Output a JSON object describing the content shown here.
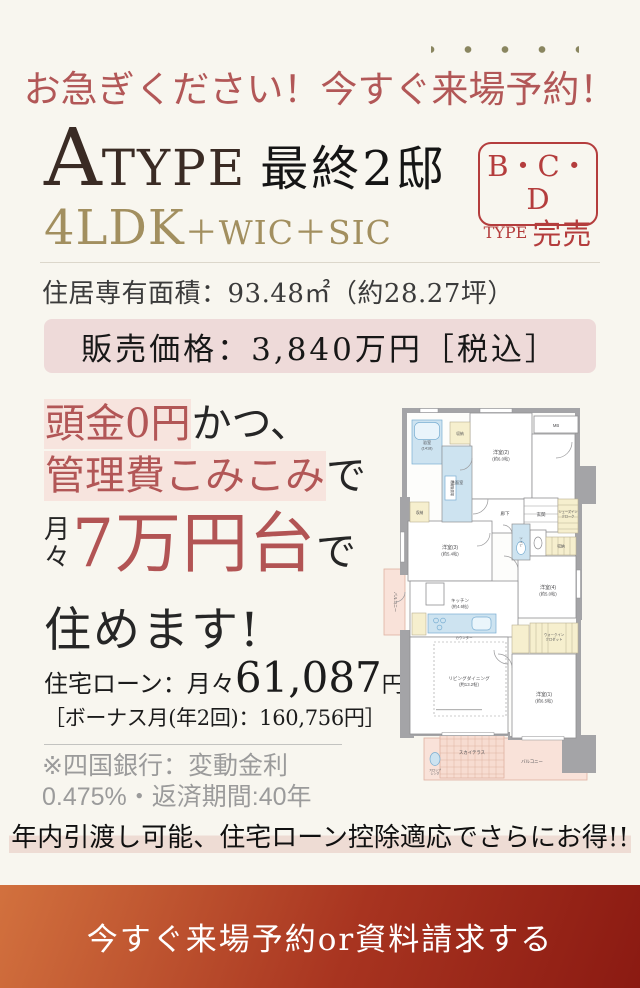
{
  "headline": {
    "pre": "お急ぎください！今すぐ",
    "emph": "来場予約",
    "post": "！",
    "color": "#b25757",
    "dot_color": "#8a8660"
  },
  "type_block": {
    "a": "A",
    "type": "TYPE",
    "rest": "最終2邸",
    "ldk_main": "4LDK",
    "ldk_sub": "＋WIC＋SIC",
    "ldk_color": "#a28f5f"
  },
  "soldout_badge": {
    "line1": "B・C・D",
    "type_label": "TYPE",
    "sold_label": "完売",
    "color": "#b43d3d"
  },
  "area": {
    "label": "住居専有面積：93.48㎡（約28.27坪）"
  },
  "price": {
    "text": "販売価格：3,840万円［税込］",
    "bg": "#eedad9"
  },
  "copy": {
    "l1_em": "頭金0円",
    "l1_rest": "かつ、",
    "l2_em": "管理費こみこみ",
    "l2_rest": "で",
    "l3_m1": "月",
    "l3_m2": "々",
    "l3_big": "7万円台",
    "l3_rest": "で",
    "l4": "住めます!",
    "accent_red": "#b25454",
    "highlight_pink": "#f7e4de"
  },
  "loan": {
    "prefix": "住宅ローン：月々",
    "amount": "61,087",
    "unit": "円",
    "bonus": "［ボーナス月(年2回)：160,756円］",
    "note1": "※四国銀行：変動金利",
    "note2": "0.475%・返済期間:40年"
  },
  "floorplan": {
    "labels": {
      "bath1": "浴室",
      "bath2": "(1418)",
      "storage_top": "収納",
      "bedroom2a": "洋室(2)",
      "bedroom2b": "(約6.0帖)",
      "mb": "MB",
      "washroom": "洗面室",
      "laundry": "洗濯機置場",
      "corridor": "廊下",
      "genkan": "玄関",
      "sic1": "シューズイン",
      "sic2": "クローク",
      "storage_left": "収納",
      "bedroom3a": "洋室(3)",
      "bedroom3b": "(約5.4帖)",
      "toilet": "トイレ",
      "storage_right": "収納",
      "bedroom4a": "洋室(4)",
      "bedroom4b": "(約5.0帖)",
      "kitchen1": "キッチン",
      "kitchen2": "(約4.6帖)",
      "counter": "カウンター",
      "ld1": "リビングダイニング",
      "ld2": "(約13.2帖)",
      "bedroom1a": "洋室(1)",
      "bedroom1b": "(約6.5帖)",
      "wic1": "ウォークイン",
      "wic2": "クロゼット",
      "terrace": "スカイテラス",
      "balcony": "バルコニー",
      "side_balcony": "バルコニー",
      "slop1": "スロップ",
      "slop2": "シンク"
    }
  },
  "bottom": {
    "catch": "年内引渡し可能、住宅ローン控除適応でさらにお得!!"
  },
  "cta": {
    "label": "今すぐ来場予約or資料請求する",
    "gradient_from": "#d2713e",
    "gradient_to": "#8b1a12"
  }
}
